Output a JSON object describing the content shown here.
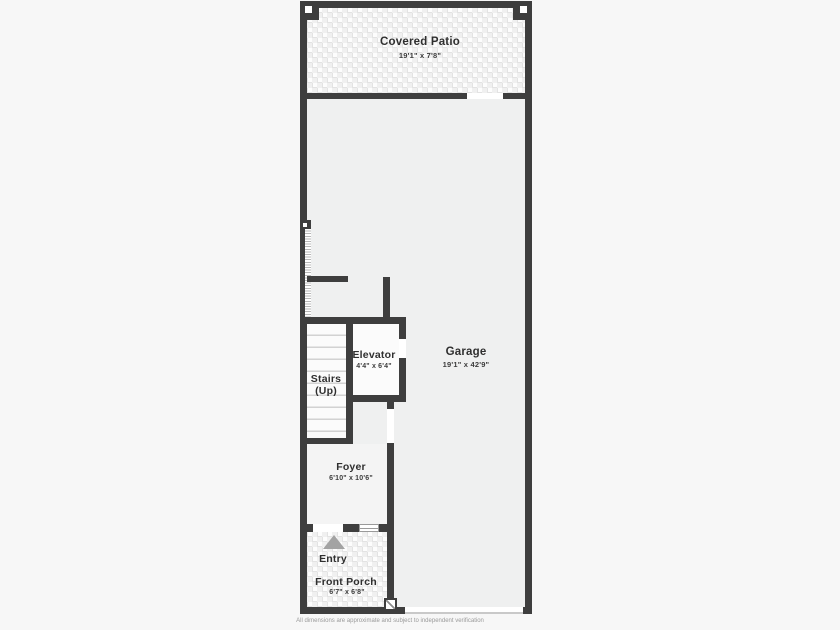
{
  "page": {
    "disclaimer": "All dimensions are approximate and subject to independent verification"
  },
  "rooms": {
    "covered_patio": {
      "name": "Covered Patio",
      "dimensions": "19'1\" x 7'8\""
    },
    "garage": {
      "name": "Garage",
      "dimensions": "19'1\" x 42'9\""
    },
    "elevator": {
      "name": "Elevator",
      "dimensions": "4'4\" x 6'4\""
    },
    "stairs": {
      "name": "Stairs",
      "direction": "(Up)"
    },
    "foyer": {
      "name": "Foyer",
      "dimensions": "6'10\" x 10'6\""
    },
    "entry": {
      "name": "Entry"
    },
    "front_porch": {
      "name": "Front Porch",
      "dimensions": "6'7\" x 6'8\""
    }
  },
  "colors": {
    "wall": "#3e3e3e",
    "floor": "#eff0f0",
    "page_background": "#f7f7f7",
    "label_text": "#2f2f2f",
    "disclaimer_text": "#9a9a9a"
  }
}
